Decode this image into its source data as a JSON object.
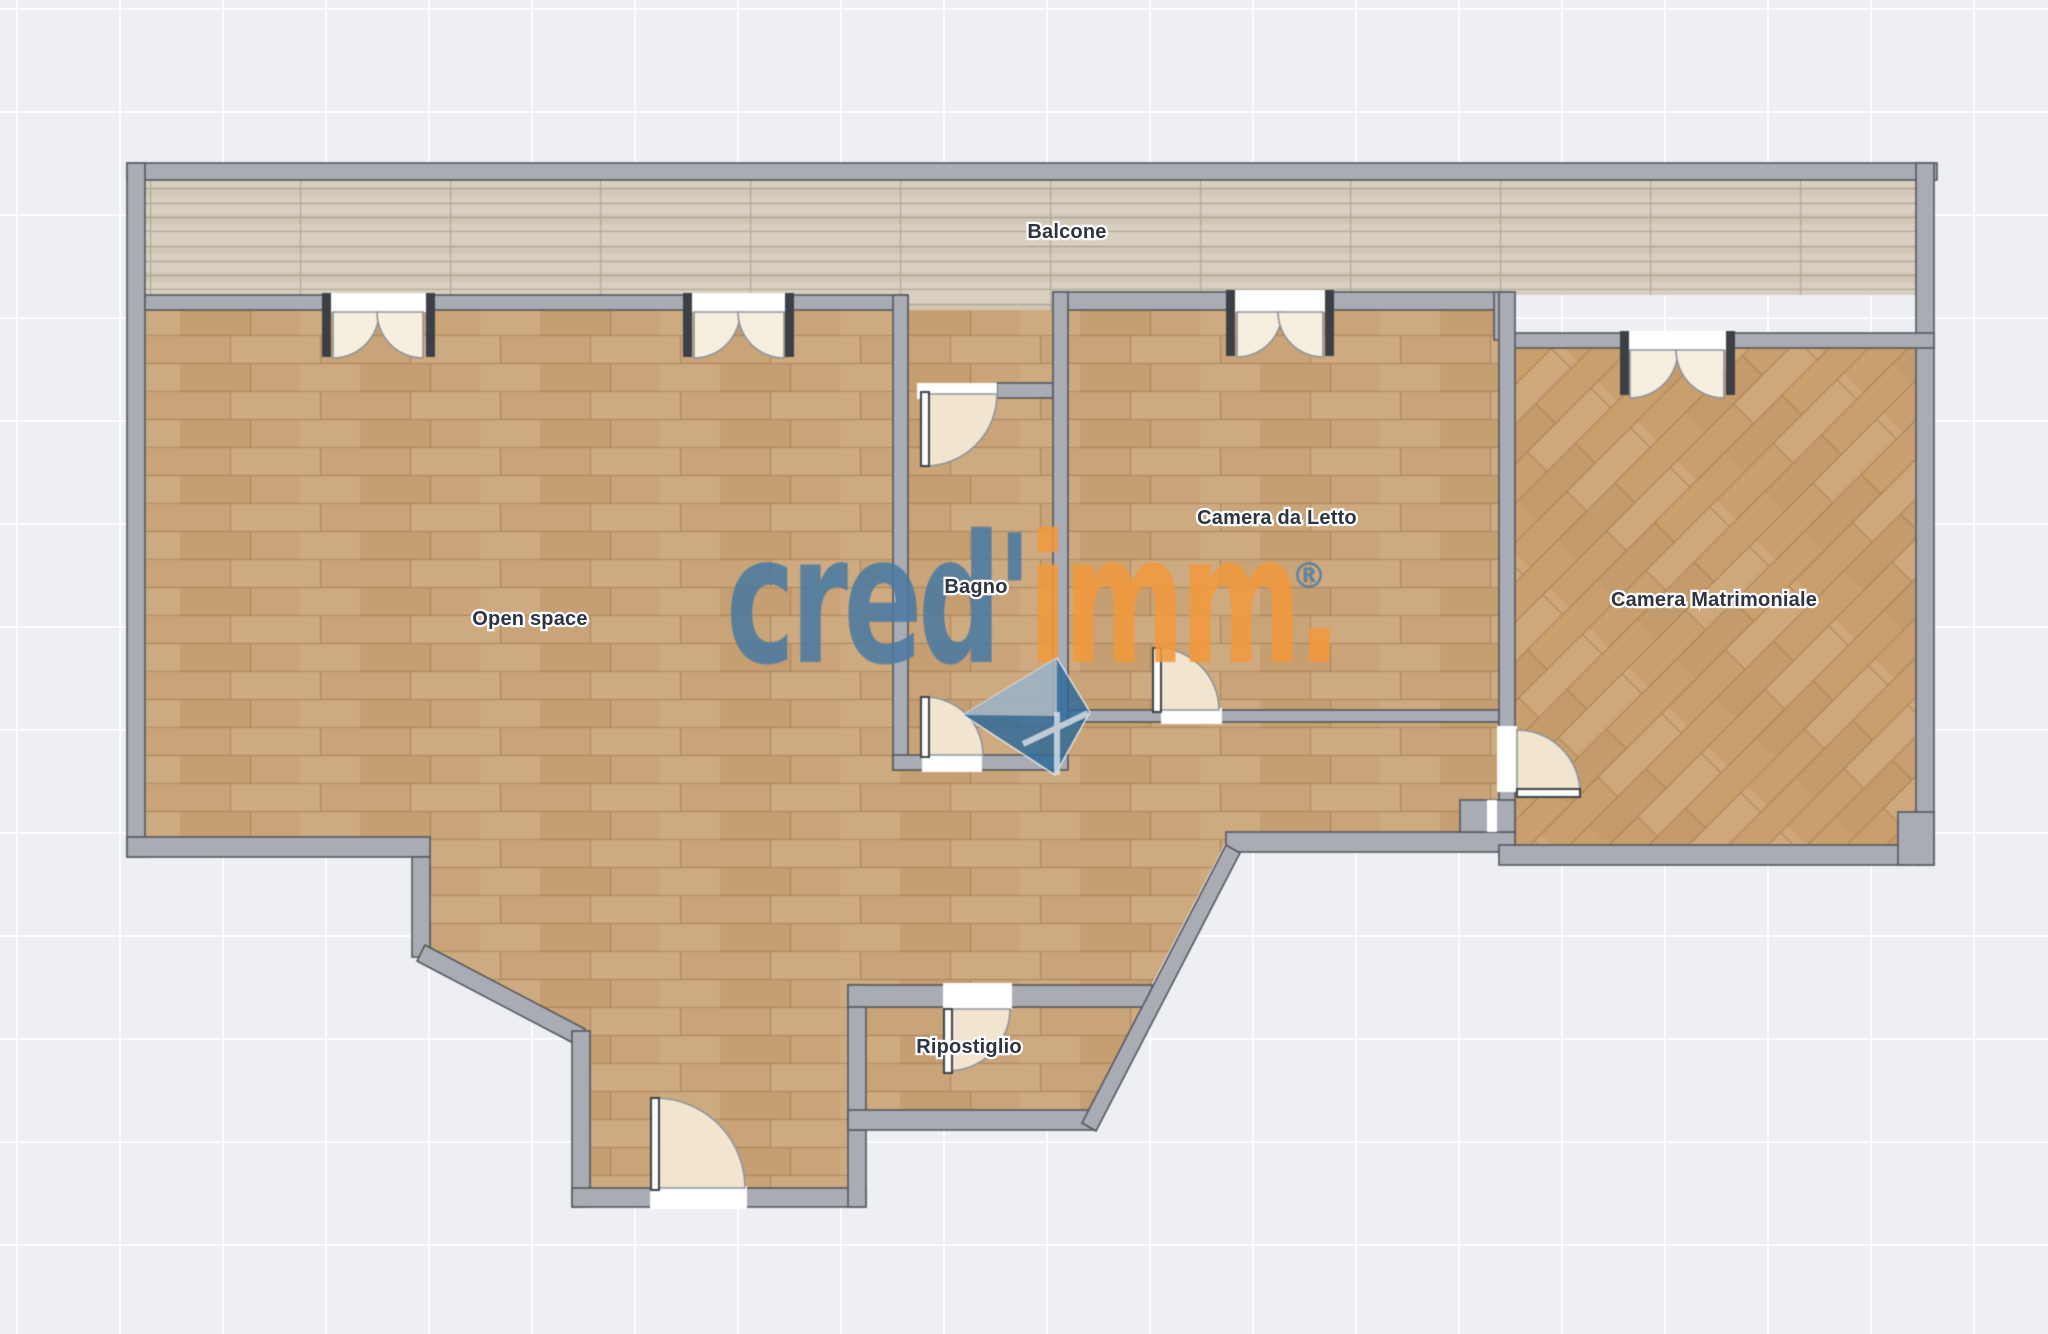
{
  "plan_title": "Apartment floor plan",
  "rooms": [
    {
      "id": "balcone",
      "label": "Balcone"
    },
    {
      "id": "open-space",
      "label": "Open space"
    },
    {
      "id": "bagno",
      "label": "Bagno"
    },
    {
      "id": "camera-da-letto",
      "label": "Camera da Letto"
    },
    {
      "id": "camera-matrimoniale",
      "label": "Camera Matrimoniale"
    },
    {
      "id": "ripostiglio",
      "label": "Ripostiglio"
    }
  ],
  "watermark": {
    "brand_left": "cred'",
    "brand_right": "imm.",
    "registered": "®"
  },
  "colors": {
    "bg": "#edeff3",
    "wall-fill": "#a9adb3",
    "wall-stroke": "#53575d",
    "wood": "#c9a478",
    "woodd": "#c89f6d",
    "balc": "#d8cfc0",
    "arc-fill": "#f1e5cf",
    "label": "#2e3440",
    "brand-blue": "#4a7aa2",
    "brand-orange": "#f2993c",
    "cube-teal": "#2d6a99"
  }
}
